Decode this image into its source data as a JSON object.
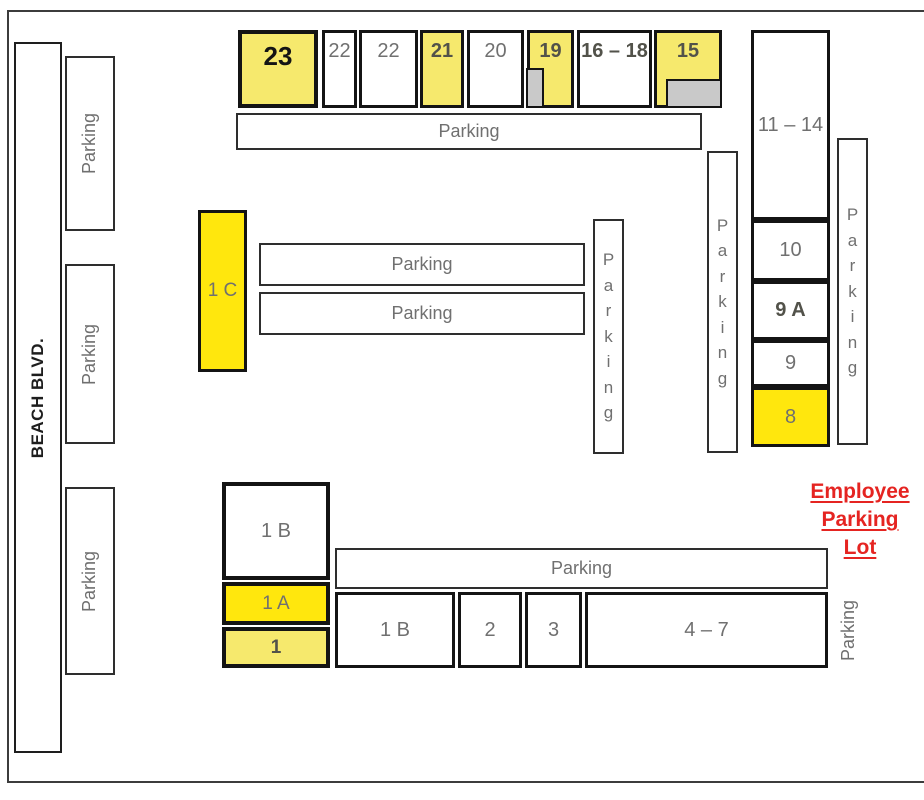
{
  "street": {
    "label": "BEACH BLVD."
  },
  "employee_lot": {
    "lines": [
      "Employee",
      "Parking",
      "Lot"
    ],
    "color": "#e52421"
  },
  "colors": {
    "pale_yellow": "#f6e96d",
    "bright_yellow": "#ffe70d",
    "gray_tab": "#c9c9c9",
    "label_gray": "#707070",
    "label_dark": "#52524a",
    "label_black": "#141414",
    "border_black": "#141414",
    "frame_gray": "#3c3c3c",
    "red": "#e52421"
  },
  "buildings": [
    {
      "name": "23",
      "label": "23",
      "x": 238,
      "y": 30,
      "w": 80,
      "h": 78,
      "fill": "pale",
      "style": "black",
      "pos": "top",
      "fs": 26,
      "bw": 4
    },
    {
      "name": "22-a",
      "label": "22",
      "x": 322,
      "y": 30,
      "w": 35,
      "h": 78,
      "fill": "white",
      "style": "gray",
      "pos": "top",
      "fs": 20,
      "bw": 3
    },
    {
      "name": "22-b",
      "label": "22",
      "x": 359,
      "y": 30,
      "w": 59,
      "h": 78,
      "fill": "white",
      "style": "gray",
      "pos": "top",
      "fs": 20,
      "bw": 3
    },
    {
      "name": "21",
      "label": "21",
      "x": 420,
      "y": 30,
      "w": 44,
      "h": 78,
      "fill": "pale",
      "style": "dark",
      "pos": "top",
      "fs": 20,
      "bw": 3
    },
    {
      "name": "20",
      "label": "20",
      "x": 467,
      "y": 30,
      "w": 57,
      "h": 78,
      "fill": "white",
      "style": "gray",
      "pos": "top",
      "fs": 20,
      "bw": 3
    },
    {
      "name": "19",
      "label": "19",
      "x": 527,
      "y": 30,
      "w": 47,
      "h": 78,
      "fill": "pale",
      "style": "dark",
      "pos": "top",
      "fs": 20,
      "bw": 3
    },
    {
      "name": "16-18",
      "label": "16 – 18",
      "x": 577,
      "y": 30,
      "w": 75,
      "h": 78,
      "fill": "white",
      "style": "dark",
      "pos": "top",
      "fs": 20,
      "bw": 3
    },
    {
      "name": "15",
      "label": "15",
      "x": 654,
      "y": 30,
      "w": 68,
      "h": 78,
      "fill": "pale",
      "style": "dark",
      "pos": "top",
      "fs": 20,
      "bw": 3
    },
    {
      "name": "11-14",
      "label": "11 – 14",
      "x": 751,
      "y": 30,
      "w": 79,
      "h": 190,
      "fill": "white",
      "style": "gray",
      "pos": "center",
      "fs": 20,
      "bw": 3
    },
    {
      "name": "10",
      "label": "10",
      "x": 751,
      "y": 220,
      "w": 79,
      "h": 61,
      "fill": "white",
      "style": "gray",
      "pos": "center",
      "fs": 20,
      "bw": 3
    },
    {
      "name": "9a",
      "label": "9 A",
      "x": 751,
      "y": 281,
      "w": 79,
      "h": 59,
      "fill": "white",
      "style": "dark",
      "pos": "center",
      "fs": 20,
      "bw": 3
    },
    {
      "name": "9",
      "label": "9",
      "x": 751,
      "y": 340,
      "w": 79,
      "h": 47,
      "fill": "white",
      "style": "gray",
      "pos": "center",
      "fs": 20,
      "bw": 3
    },
    {
      "name": "8",
      "label": "8",
      "x": 751,
      "y": 387,
      "w": 79,
      "h": 60,
      "fill": "bright",
      "style": "gray",
      "pos": "center",
      "fs": 20,
      "bw": 3
    },
    {
      "name": "1c",
      "label": "1 C",
      "x": 198,
      "y": 210,
      "w": 49,
      "h": 162,
      "fill": "bright",
      "style": "gray",
      "pos": "center",
      "fs": 19,
      "bw": 3
    },
    {
      "name": "1b-upper",
      "label": "1 B",
      "x": 222,
      "y": 482,
      "w": 108,
      "h": 98,
      "fill": "white",
      "style": "gray",
      "pos": "center",
      "fs": 20,
      "bw": 4
    },
    {
      "name": "1a",
      "label": "1 A",
      "x": 222,
      "y": 582,
      "w": 108,
      "h": 43,
      "fill": "bright",
      "style": "gray",
      "pos": "center",
      "fs": 19,
      "bw": 4
    },
    {
      "name": "1",
      "label": "1",
      "x": 222,
      "y": 627,
      "w": 108,
      "h": 41,
      "fill": "pale",
      "style": "dark",
      "pos": "center",
      "fs": 19,
      "bw": 4
    },
    {
      "name": "1b-lower",
      "label": "1 B",
      "x": 335,
      "y": 592,
      "w": 120,
      "h": 76,
      "fill": "white",
      "style": "gray",
      "pos": "center",
      "fs": 20,
      "bw": 3
    },
    {
      "name": "2",
      "label": "2",
      "x": 458,
      "y": 592,
      "w": 64,
      "h": 76,
      "fill": "white",
      "style": "gray",
      "pos": "center",
      "fs": 20,
      "bw": 3
    },
    {
      "name": "3",
      "label": "3",
      "x": 525,
      "y": 592,
      "w": 57,
      "h": 76,
      "fill": "white",
      "style": "gray",
      "pos": "center",
      "fs": 20,
      "bw": 3
    },
    {
      "name": "4-7",
      "label": "4 – 7",
      "x": 585,
      "y": 592,
      "w": 243,
      "h": 76,
      "fill": "white",
      "style": "gray",
      "pos": "center",
      "fs": 20,
      "bw": 3
    }
  ],
  "gray_tabs": [
    {
      "name": "building-19-entrance",
      "x": 526,
      "y": 68,
      "w": 18,
      "h": 40
    },
    {
      "name": "building-15-entrance",
      "x": 666,
      "y": 79,
      "w": 56,
      "h": 29
    }
  ],
  "parking_areas": [
    {
      "name": "parking-left-1",
      "label": "Parking",
      "x": 65,
      "y": 56,
      "w": 50,
      "h": 175,
      "mode": "rot",
      "boxed": true
    },
    {
      "name": "parking-left-2",
      "label": "Parking",
      "x": 65,
      "y": 264,
      "w": 50,
      "h": 180,
      "mode": "rot",
      "boxed": true
    },
    {
      "name": "parking-left-3",
      "label": "Parking",
      "x": 65,
      "y": 487,
      "w": 50,
      "h": 188,
      "mode": "rot",
      "boxed": true
    },
    {
      "name": "parking-top-strip",
      "label": "Parking",
      "x": 236,
      "y": 113,
      "w": 466,
      "h": 37,
      "mode": "h",
      "boxed": true
    },
    {
      "name": "parking-mid-strip-1",
      "label": "Parking",
      "x": 259,
      "y": 243,
      "w": 326,
      "h": 43,
      "mode": "h",
      "boxed": true
    },
    {
      "name": "parking-mid-strip-2",
      "label": "Parking",
      "x": 259,
      "y": 292,
      "w": 326,
      "h": 43,
      "mode": "h",
      "boxed": true
    },
    {
      "name": "parking-vertical-mid",
      "label": "Parking",
      "x": 593,
      "y": 219,
      "w": 31,
      "h": 235,
      "mode": "stack",
      "boxed": true
    },
    {
      "name": "parking-vertical-right",
      "label": "Parking",
      "x": 707,
      "y": 151,
      "w": 31,
      "h": 302,
      "mode": "stack",
      "boxed": true
    },
    {
      "name": "parking-vertical-far-right",
      "label": "Parking",
      "x": 837,
      "y": 138,
      "w": 31,
      "h": 307,
      "mode": "stack",
      "boxed": true
    },
    {
      "name": "parking-bottom-strip",
      "label": "Parking",
      "x": 335,
      "y": 548,
      "w": 493,
      "h": 41,
      "mode": "h",
      "boxed": true
    },
    {
      "name": "parking-bottom-right",
      "label": "Parking",
      "x": 833,
      "y": 592,
      "w": 32,
      "h": 76,
      "mode": "rot",
      "boxed": false
    }
  ]
}
